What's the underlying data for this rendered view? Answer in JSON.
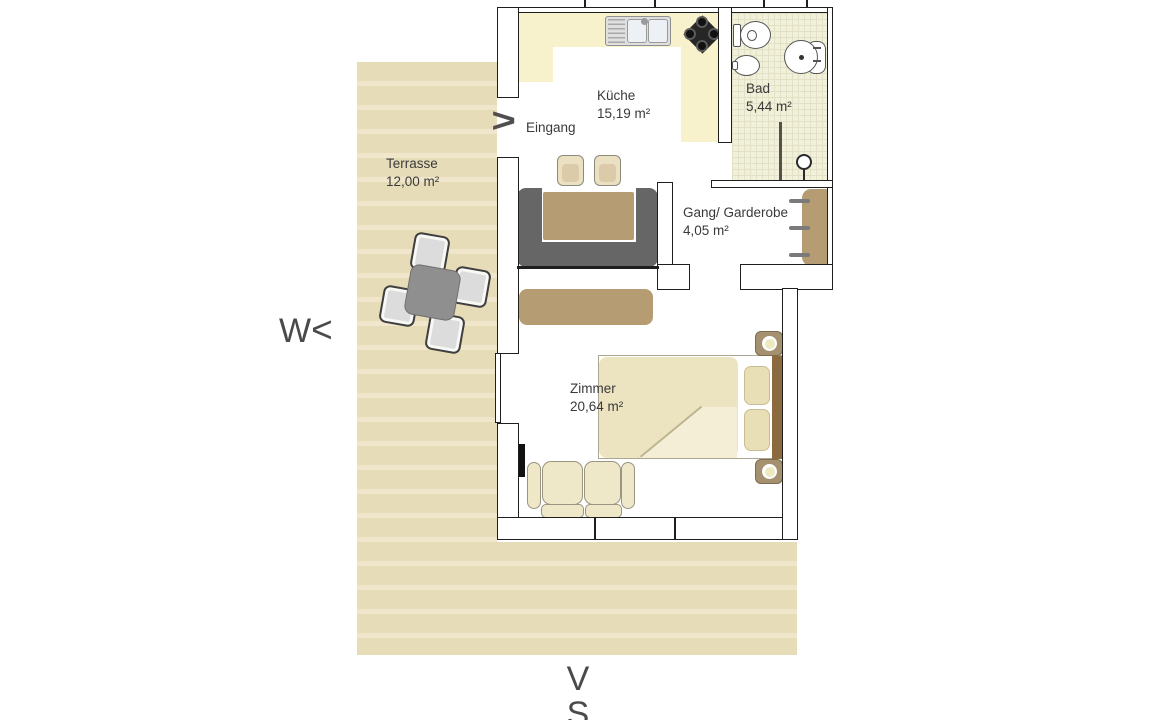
{
  "plan": {
    "rooms": [
      {
        "label": "Terrasse",
        "area": "12,00 m²"
      },
      {
        "label": "Küche",
        "area": "15,19 m²"
      },
      {
        "label": "Bad",
        "area": "5,44 m²"
      },
      {
        "label": "Gang/ Garderobe",
        "area": "4,05 m²"
      },
      {
        "label": "Zimmer",
        "area": "20,64 m²"
      }
    ],
    "entrance": {
      "arrow": ">",
      "label": "Eingang"
    },
    "compass": {
      "west": "W",
      "west_arrow": "<",
      "south_arrow": "V",
      "south": "S"
    },
    "colors": {
      "terrace": "#e7dcb8",
      "terrace_stripe": "#efe6cb",
      "kitchen_counter": "#f8f2cc",
      "bath_tile": "#f1f0db",
      "bench_gray": "#666666",
      "wood_tan": "#b59c73",
      "bed_cream": "#ece4c0",
      "headboard_brown": "#8a6a3e",
      "wall_outline": "#1f1f1f"
    }
  }
}
